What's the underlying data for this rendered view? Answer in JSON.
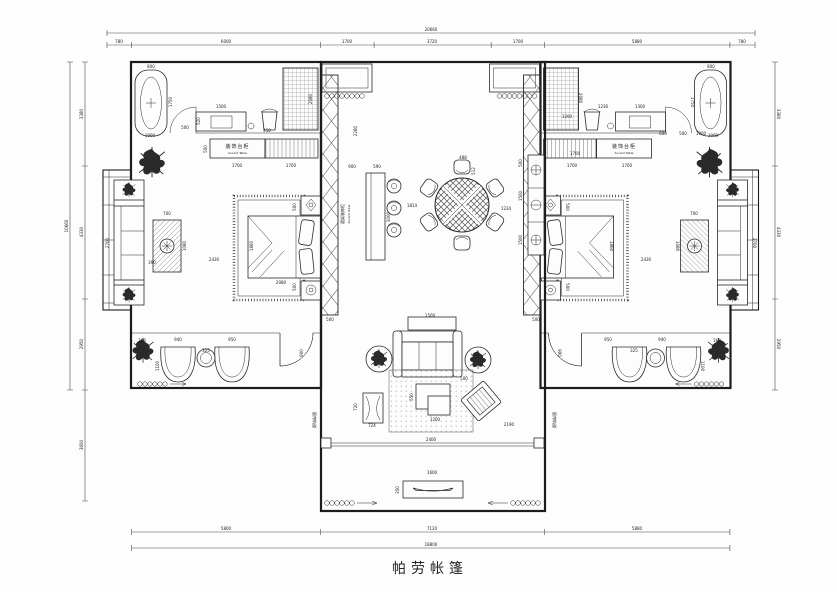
{
  "title": "帕劳帐篷",
  "colors": {
    "line": "#1c1c1c",
    "dim_text": "#1a1a1a",
    "background": "#fdfdfd"
  },
  "labels": {
    "accent_table_cn": "装饰台柜",
    "accent_table_en": "Accent Table",
    "wine_rack_cn": "酒架装饰柜",
    "wine_rack_en": "Accent Table",
    "curtain_track": "窗帘轨道"
  },
  "annotations": [
    {
      "x": 431,
      "y": 31,
      "t": "20660"
    },
    {
      "x": 119,
      "y": 43,
      "t": "780"
    },
    {
      "x": 226,
      "y": 43,
      "t": "6000"
    },
    {
      "x": 347,
      "y": 43,
      "t": "1700"
    },
    {
      "x": 432,
      "y": 43,
      "t": "3720"
    },
    {
      "x": 518,
      "y": 43,
      "t": "1700"
    },
    {
      "x": 637,
      "y": 43,
      "t": "5880"
    },
    {
      "x": 742,
      "y": 43,
      "t": "780"
    },
    {
      "x": 226,
      "y": 530,
      "t": "5800"
    },
    {
      "x": 432,
      "y": 530,
      "t": "7120"
    },
    {
      "x": 637,
      "y": 530,
      "t": "5880"
    },
    {
      "x": 431,
      "y": 546,
      "t": "18800"
    },
    {
      "x": 68,
      "y": 226,
      "t": "10660",
      "r": -90
    },
    {
      "x": 83,
      "y": 114,
      "t": "3380",
      "r": -90
    },
    {
      "x": 83,
      "y": 232,
      "t": "4330",
      "r": -90
    },
    {
      "x": 83,
      "y": 344,
      "t": "2950",
      "r": -90
    },
    {
      "x": 83,
      "y": 445,
      "t": "3600",
      "r": -90
    },
    {
      "x": 777,
      "y": 114,
      "t": "3380",
      "r": 90
    },
    {
      "x": 777,
      "y": 232,
      "t": "4330",
      "r": 90
    },
    {
      "x": 777,
      "y": 344,
      "t": "2950",
      "r": 90
    },
    {
      "x": 151,
      "y": 68,
      "t": "800"
    },
    {
      "x": 172,
      "y": 102,
      "t": "1750",
      "r": -90
    },
    {
      "x": 150,
      "y": 137,
      "t": "1000"
    },
    {
      "x": 185,
      "y": 129,
      "t": "500"
    },
    {
      "x": 221,
      "y": 108,
      "t": "1500"
    },
    {
      "x": 200,
      "y": 121,
      "t": "520",
      "r": -90
    },
    {
      "x": 267,
      "y": 132,
      "t": "450"
    },
    {
      "x": 312,
      "y": 99,
      "t": "2080",
      "r": -90
    },
    {
      "x": 207,
      "y": 149,
      "t": "500",
      "r": -90
    },
    {
      "x": 237,
      "y": 167,
      "t": "1700"
    },
    {
      "x": 291,
      "y": 167,
      "t": "1700"
    },
    {
      "x": 167,
      "y": 215,
      "t": "700"
    },
    {
      "x": 186,
      "y": 246,
      "t": "1080",
      "r": -90
    },
    {
      "x": 109,
      "y": 243,
      "t": "2700",
      "r": -90
    },
    {
      "x": 152,
      "y": 264,
      "t": "390"
    },
    {
      "x": 214,
      "y": 261,
      "t": "2430"
    },
    {
      "x": 253,
      "y": 246,
      "t": "1860",
      "r": -90
    },
    {
      "x": 296,
      "y": 207,
      "t": "500",
      "r": -90
    },
    {
      "x": 296,
      "y": 287,
      "t": "500",
      "r": -90
    },
    {
      "x": 281,
      "y": 284,
      "t": "2080"
    },
    {
      "x": 142,
      "y": 342,
      "t": "368"
    },
    {
      "x": 178,
      "y": 341,
      "t": "940"
    },
    {
      "x": 232,
      "y": 341,
      "t": "950"
    },
    {
      "x": 206,
      "y": 352,
      "t": "325"
    },
    {
      "x": 159,
      "y": 366,
      "t": "1100",
      "r": -90
    },
    {
      "x": 303,
      "y": 353,
      "t": "900",
      "r": -90
    },
    {
      "x": 357,
      "y": 131,
      "t": "2280",
      "r": -90
    },
    {
      "x": 352,
      "y": 168,
      "t": "900"
    },
    {
      "x": 377,
      "y": 168,
      "t": "590"
    },
    {
      "x": 390,
      "y": 217,
      "t": "3000",
      "r": -90
    },
    {
      "x": 412,
      "y": 207,
      "t": "1814"
    },
    {
      "x": 463,
      "y": 159,
      "t": "488"
    },
    {
      "x": 475,
      "y": 171,
      "t": "512",
      "r": -90
    },
    {
      "x": 506,
      "y": 210,
      "t": "1234"
    },
    {
      "x": 522,
      "y": 163,
      "t": "500",
      "r": -90
    },
    {
      "x": 522,
      "y": 196,
      "t": "1500",
      "r": -90
    },
    {
      "x": 522,
      "y": 240,
      "t": "1500",
      "r": -90
    },
    {
      "x": 330,
      "y": 321,
      "t": "500"
    },
    {
      "x": 536,
      "y": 321,
      "t": "500"
    },
    {
      "x": 575,
      "y": 155,
      "t": "1700"
    },
    {
      "x": 430,
      "y": 317,
      "t": "1500"
    },
    {
      "x": 413,
      "y": 397,
      "t": "550",
      "r": -90
    },
    {
      "x": 435,
      "y": 421,
      "t": "1200"
    },
    {
      "x": 357,
      "y": 407,
      "t": "720",
      "r": -90
    },
    {
      "x": 372,
      "y": 427,
      "t": "724"
    },
    {
      "x": 431,
      "y": 441,
      "t": "2400"
    },
    {
      "x": 509,
      "y": 426,
      "t": "2190"
    },
    {
      "x": 464,
      "y": 380,
      "t": "500"
    },
    {
      "x": 432,
      "y": 474,
      "t": "1600"
    },
    {
      "x": 399,
      "y": 490,
      "t": "350",
      "r": -90
    },
    {
      "x": 711,
      "y": 68,
      "t": "800"
    },
    {
      "x": 691,
      "y": 102,
      "t": "1750",
      "r": 90
    },
    {
      "x": 713,
      "y": 137,
      "t": "1000"
    },
    {
      "x": 603,
      "y": 108,
      "t": "1236"
    },
    {
      "x": 640,
      "y": 108,
      "t": "1300"
    },
    {
      "x": 663,
      "y": 135,
      "t": "600"
    },
    {
      "x": 683,
      "y": 135,
      "t": "500"
    },
    {
      "x": 701,
      "y": 135,
      "t": "1000"
    },
    {
      "x": 567,
      "y": 118,
      "t": "1200"
    },
    {
      "x": 579,
      "y": 98,
      "t": "2080",
      "r": 90
    },
    {
      "x": 572,
      "y": 167,
      "t": "1700"
    },
    {
      "x": 627,
      "y": 167,
      "t": "1700"
    },
    {
      "x": 694,
      "y": 215,
      "t": "700"
    },
    {
      "x": 676,
      "y": 246,
      "t": "1080",
      "r": 90
    },
    {
      "x": 753,
      "y": 243,
      "t": "2700",
      "r": 90
    },
    {
      "x": 646,
      "y": 261,
      "t": "2430"
    },
    {
      "x": 610,
      "y": 246,
      "t": "1860",
      "r": 90
    },
    {
      "x": 566,
      "y": 207,
      "t": "500",
      "r": 90
    },
    {
      "x": 566,
      "y": 287,
      "t": "500",
      "r": 90
    },
    {
      "x": 717,
      "y": 342,
      "t": "368"
    },
    {
      "x": 662,
      "y": 341,
      "t": "940"
    },
    {
      "x": 608,
      "y": 341,
      "t": "950"
    },
    {
      "x": 634,
      "y": 352,
      "t": "325"
    },
    {
      "x": 701,
      "y": 366,
      "t": "1100",
      "r": 90
    },
    {
      "x": 558,
      "y": 353,
      "t": "900",
      "r": 90
    }
  ]
}
